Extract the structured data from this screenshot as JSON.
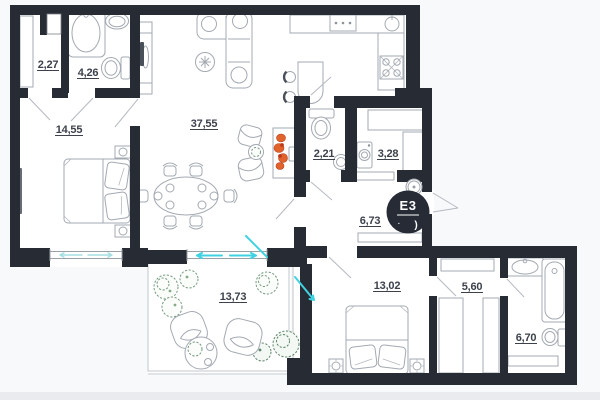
{
  "plan": {
    "type": "apartment-floor-plan",
    "logo": {
      "text": "E3",
      "bracket": ")",
      "dot": "·"
    },
    "rooms": [
      {
        "name": "closet-entry",
        "area": "2,27"
      },
      {
        "name": "bathroom-top",
        "area": "4,26"
      },
      {
        "name": "bedroom-left",
        "area": "14,55"
      },
      {
        "name": "living-kitchen",
        "area": "37,55"
      },
      {
        "name": "wc",
        "area": "2,21"
      },
      {
        "name": "storage",
        "area": "3,28"
      },
      {
        "name": "hallway",
        "area": "6,73"
      },
      {
        "name": "bedroom-right",
        "area": "13,02"
      },
      {
        "name": "terrace",
        "area": "13,73"
      },
      {
        "name": "walk-in-closet",
        "area": "5,60"
      },
      {
        "name": "bathroom-bottom",
        "area": "6,70"
      }
    ],
    "colors": {
      "wall": "#272b34",
      "furniture_line": "#a3a9b1",
      "label_text": "#3c414b",
      "accent_cyan": "#3fd2e2",
      "window_cyan": "#a5dfe3",
      "plant_green": "#74997e",
      "flame_orange": "#e2622c",
      "logo_bg": "#262b36"
    }
  }
}
